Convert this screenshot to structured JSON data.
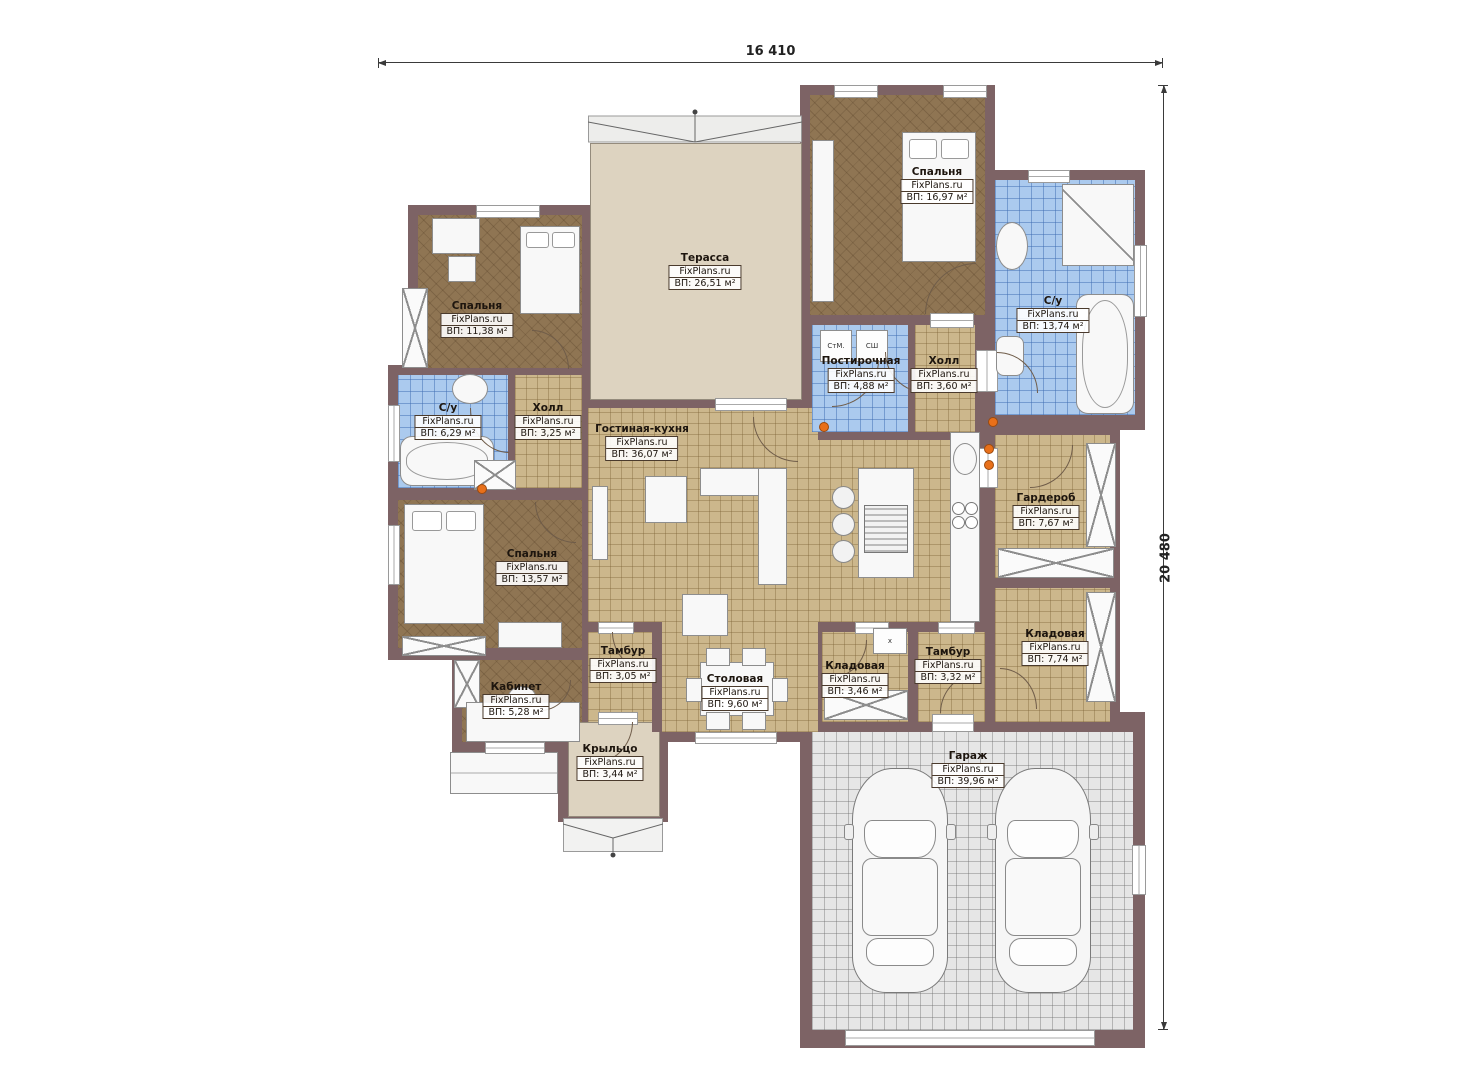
{
  "watermark": "FixPlans.ru",
  "dimensions": {
    "width_label": "16 410",
    "height_label": "20 480"
  },
  "rooms": [
    {
      "id": "bedroom-top-right",
      "name": "Спальня",
      "area": "ВП: 16,97 м²"
    },
    {
      "id": "bathroom-top-right",
      "name": "С/у",
      "area": "ВП: 13,74 м²"
    },
    {
      "id": "terrace",
      "name": "Терасса",
      "area": "ВП: 26,51 м²"
    },
    {
      "id": "bedroom-top-left",
      "name": "Спальня",
      "area": "ВП: 11,38 м²"
    },
    {
      "id": "bathroom-left",
      "name": "С/у",
      "area": "ВП: 6,29 м²"
    },
    {
      "id": "hall-left",
      "name": "Холл",
      "area": "ВП: 3,25 м²"
    },
    {
      "id": "living-kitchen",
      "name": "Гостиная-кухня",
      "area": "ВП: 36,07 м²"
    },
    {
      "id": "laundry",
      "name": "Постирочная",
      "area": "ВП: 4,88 м²"
    },
    {
      "id": "hall-middle",
      "name": "Холл",
      "area": "ВП: 3,60 м²"
    },
    {
      "id": "wardrobe",
      "name": "Гардероб",
      "area": "ВП: 7,67 м²"
    },
    {
      "id": "bedroom-left",
      "name": "Спальня",
      "area": "ВП: 13,57 м²"
    },
    {
      "id": "storage-right",
      "name": "Кладовая",
      "area": "ВП: 7,74 м²"
    },
    {
      "id": "office",
      "name": "Кабинет",
      "area": "ВП: 5,28 м²"
    },
    {
      "id": "tambour-left",
      "name": "Тамбур",
      "area": "ВП: 3,05 м²"
    },
    {
      "id": "dining",
      "name": "Столовая",
      "area": "ВП: 9,60 м²"
    },
    {
      "id": "storage-middle",
      "name": "Кладовая",
      "area": "ВП: 3,46 м²"
    },
    {
      "id": "tambour-right",
      "name": "Тамбур",
      "area": "ВП: 3,32 м²"
    },
    {
      "id": "porch",
      "name": "Крыльцо",
      "area": "ВП: 3,44 м²"
    },
    {
      "id": "garage",
      "name": "Гараж",
      "area": "ВП: 39,96 м²"
    }
  ],
  "appliances": {
    "washer": "СтМ.",
    "dryer": "СШ",
    "heater": "х"
  },
  "colors": {
    "wall": "#7d6365",
    "floor_wood": "#8f7553",
    "floor_tile_tan": "#ccb78c",
    "floor_tile_blue": "#abcaee",
    "terrace": "#ddd3c0",
    "garage": "#e6e6e6",
    "accent_orange": "#e8701a"
  }
}
